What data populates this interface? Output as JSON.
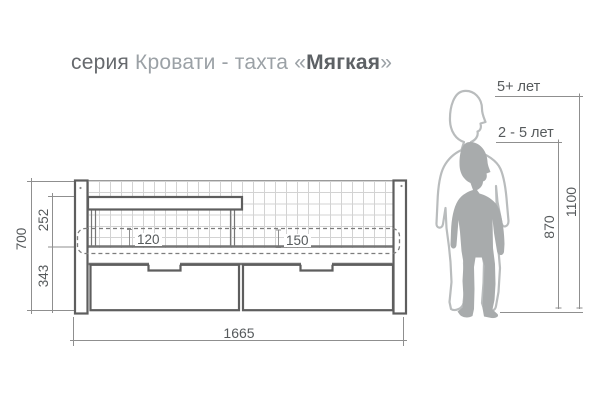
{
  "title": {
    "series_label": "серия",
    "series_name": "Кровати - тахта",
    "quote_open": "«",
    "product_name": "Мягкая",
    "quote_close": "»"
  },
  "dimensions": {
    "total_height": "700",
    "backrest_height": "252",
    "underbed_height": "343",
    "mattress_seat": "120",
    "mattress_back": "150",
    "total_length": "1665"
  },
  "age_chart": {
    "older_age_label": "5+ лет",
    "older_height": "1100",
    "younger_age_label": "2 - 5 лет",
    "younger_height": "870"
  },
  "colors": {
    "line": "#5e5e5e",
    "dim": "#8f8f8f",
    "grid": "#d3d3d3",
    "mesh_top": "#9a9a9a",
    "sil_fill": "#a8abac",
    "sil_outline": "#b9bcbd",
    "title_muted": "#9ba1a6",
    "title_dark": "#66696d",
    "label": "#565a5c"
  }
}
